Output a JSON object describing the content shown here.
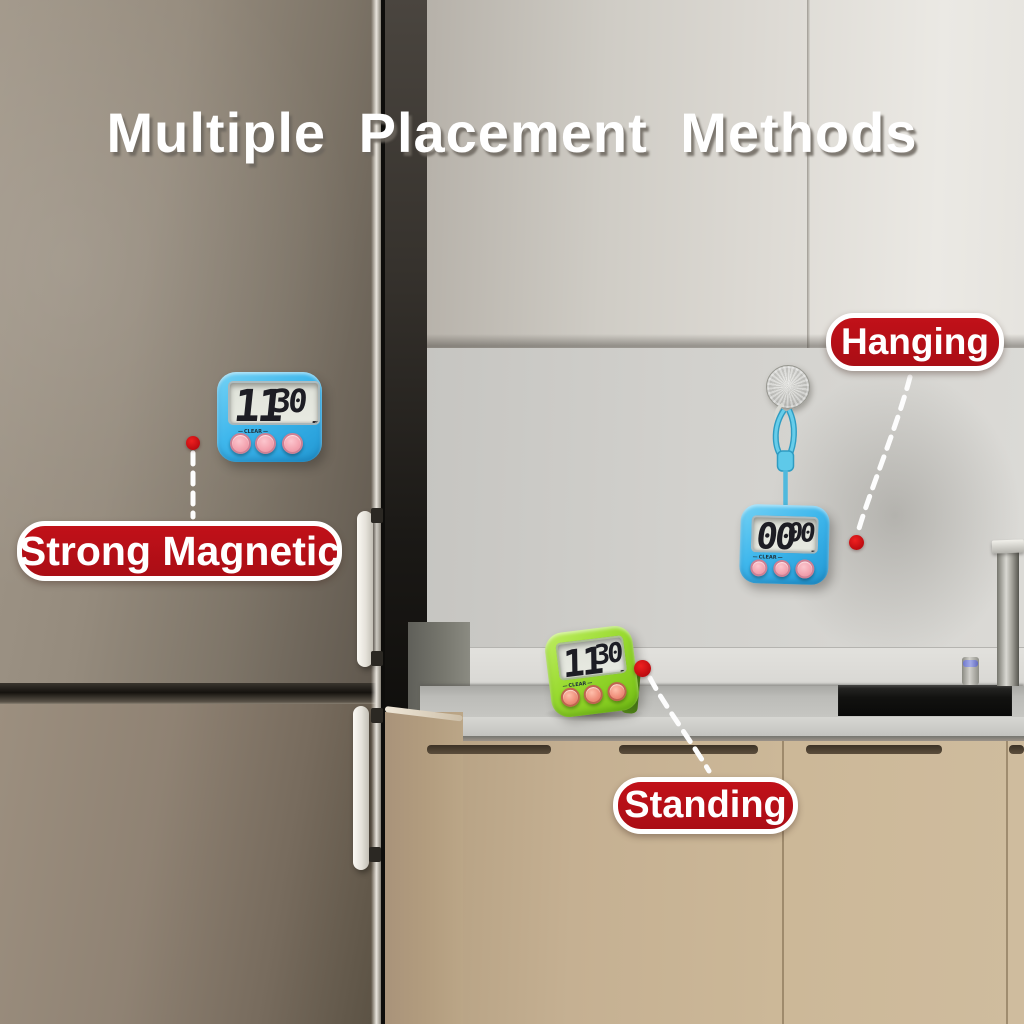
{
  "title": "Multiple Placement Methods",
  "badges": {
    "magnetic": {
      "label": "Strong Magnetic"
    },
    "hanging": {
      "label": "Hanging"
    },
    "standing": {
      "label": "Standing"
    }
  },
  "timers": {
    "magnetic": {
      "minutes": "11",
      "seconds": "30",
      "minute_label": "M",
      "second_label": "S",
      "clear_label": "CLEAR",
      "color": "#3fb7ec"
    },
    "hanging": {
      "minutes": "00",
      "seconds": "00",
      "minute_label": "M",
      "second_label": "S",
      "clear_label": "CLEAR",
      "color": "#3fb7ec"
    },
    "standing": {
      "minutes": "11",
      "seconds": "30",
      "minute_label": "M",
      "second_label": "S",
      "clear_label": "CLEAR",
      "color": "#99da30"
    }
  },
  "colors": {
    "badge_red": "#b6101a",
    "dot_red": "#d5100f",
    "lanyard_blue": "#5ec9e9",
    "button_pink": "#f4a5b1",
    "button_orange": "#f0917d"
  }
}
